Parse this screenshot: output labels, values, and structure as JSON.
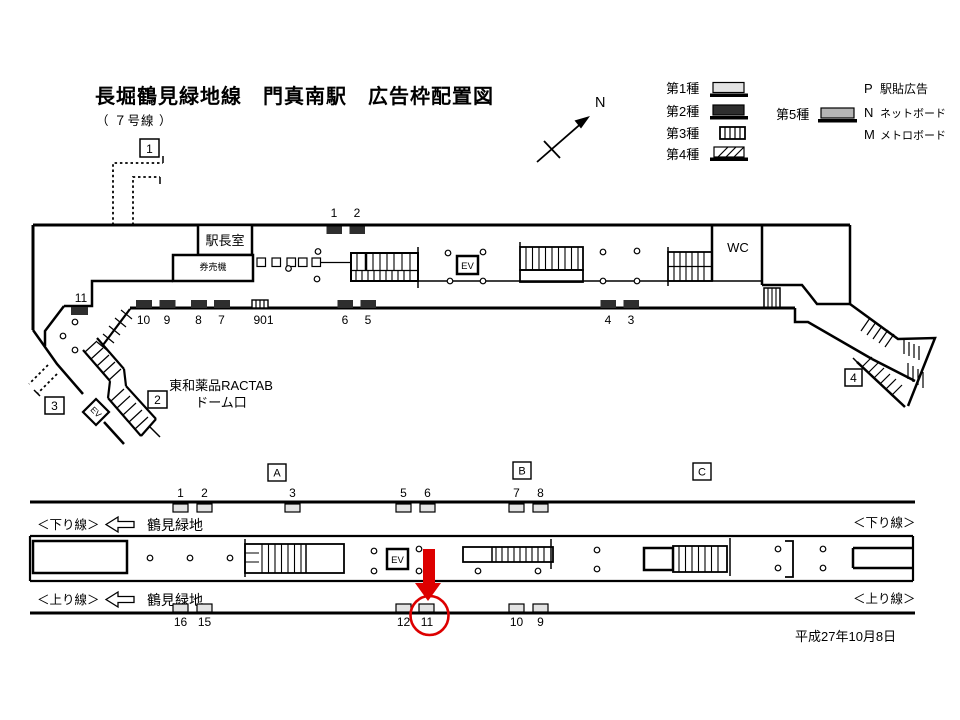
{
  "title": "長堀鶴見緑地線　門真南駅　広告枠配置図",
  "subtitle": "（ ７号線 ）",
  "north_label": "N",
  "legend": {
    "type1": "第1種",
    "type2": "第2種",
    "type3": "第3種",
    "type4": "第4種",
    "type5": "第5種",
    "p_key": "P",
    "p_label": "駅貼広告",
    "n_key": "N",
    "n_label": "ネットボード",
    "m_key": "M",
    "m_label": "メトロボード"
  },
  "concourse": {
    "station_office": "駅長室",
    "ticket_machines": "券売機",
    "wc": "WC",
    "elevator": "EV",
    "exit_elevator": "EV",
    "exits": {
      "e1": "1",
      "e2": "2",
      "e3": "3",
      "e4": "4"
    },
    "note_line1": "東和薬品RACTAB",
    "note_line2": "ドーム口",
    "top_ads": [
      "1",
      "2"
    ],
    "left_ad": "11",
    "bottom_ads": [
      "10",
      "9",
      "8",
      "7",
      "901",
      "6",
      "5",
      "4",
      "3"
    ]
  },
  "platform": {
    "sections": [
      "A",
      "B",
      "C"
    ],
    "top_ads": [
      "1",
      "2",
      "3",
      "5",
      "6",
      "7",
      "8"
    ],
    "bottom_ads": [
      "16",
      "15",
      "12",
      "11",
      "10",
      "9"
    ],
    "down_line": "＜下り線＞",
    "up_line": "＜上り線＞",
    "direction": "鶴見緑地",
    "elevator": "EV",
    "highlighted_position": "11"
  },
  "date": "平成27年10月8日",
  "colors": {
    "highlight": "#dd0000",
    "type1_fill": "#e3e3e3",
    "type2_fill": "#2e2e2e",
    "type5_fill": "#b5b5b5"
  }
}
